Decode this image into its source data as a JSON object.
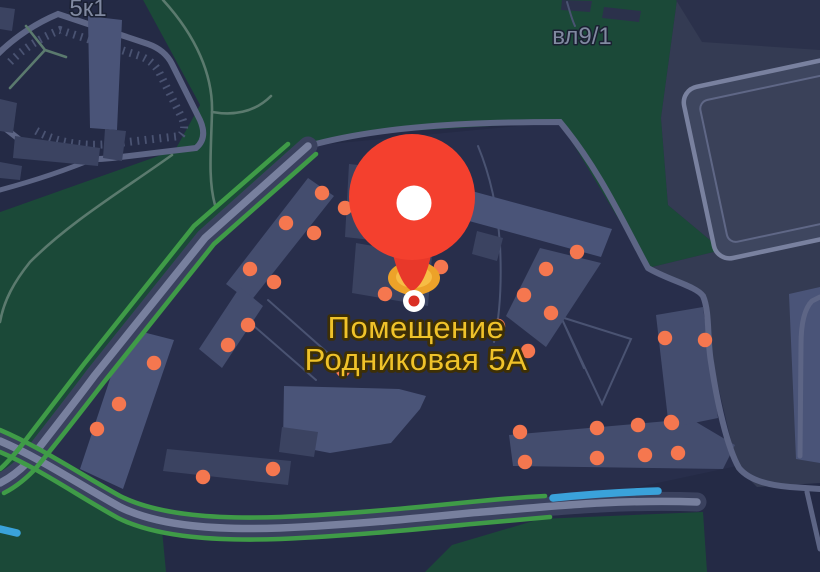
{
  "app": "dark-map-view",
  "labels": {
    "block_left": "5к1",
    "plot_right": "вл9/1",
    "place_line1": "Помещение",
    "place_line2": "Родниковая 5А"
  },
  "pin": {
    "x": 412,
    "y": 197,
    "radius": 63,
    "hole_radius": 17.5,
    "point_x": 414,
    "point_y": 301
  },
  "entrance_markers": [
    [
      322,
      193
    ],
    [
      345,
      208
    ],
    [
      286,
      223
    ],
    [
      314,
      233
    ],
    [
      250,
      269
    ],
    [
      274,
      282
    ],
    [
      248,
      325
    ],
    [
      228,
      345
    ],
    [
      385,
      294
    ],
    [
      441,
      267
    ],
    [
      498,
      326
    ],
    [
      524,
      295
    ],
    [
      551,
      313
    ],
    [
      528,
      351
    ],
    [
      343,
      370
    ],
    [
      577,
      252
    ],
    [
      546,
      269
    ],
    [
      665,
      338
    ],
    [
      705,
      340
    ],
    [
      671,
      422
    ],
    [
      520,
      432
    ],
    [
      597,
      428
    ],
    [
      638,
      425
    ],
    [
      672,
      423
    ],
    [
      525,
      462
    ],
    [
      597,
      458
    ],
    [
      645,
      455
    ],
    [
      678,
      453
    ],
    [
      154,
      363
    ],
    [
      119,
      404
    ],
    [
      97,
      429
    ],
    [
      203,
      477
    ],
    [
      273,
      469
    ]
  ],
  "entrance_radius": 7.2,
  "colors": {
    "bg": "#242a45",
    "block": "#282e4b",
    "park": "#1b4938",
    "park_path": "#5b7a6e",
    "zone_right": "#343b53",
    "road": "#5d6585",
    "road_casing": "#3a415e",
    "road_core": "#78809e",
    "thin_path": "#4a5372",
    "building": "#3b4361",
    "building_light": "#4a5478",
    "building_mid": "#444d6e",
    "building_dark": "#2b314b",
    "green_lane": "#3f9b47",
    "blue_lane": "#3aa2da",
    "entrance": "#f5774f",
    "pin_red": "#f4402e",
    "pin_tail": "#e8382a",
    "pin_hole": "#ffffff",
    "glow_outer": "#eda229",
    "glow_inner": "#f7bd45",
    "marker_ring": "#ffffff",
    "marker_center": "#da2f24",
    "place_label": "#efc22a",
    "place_label_outline": "#3d2f06",
    "map_label": "#8089a0",
    "map_label_halo": "#1a2032"
  }
}
